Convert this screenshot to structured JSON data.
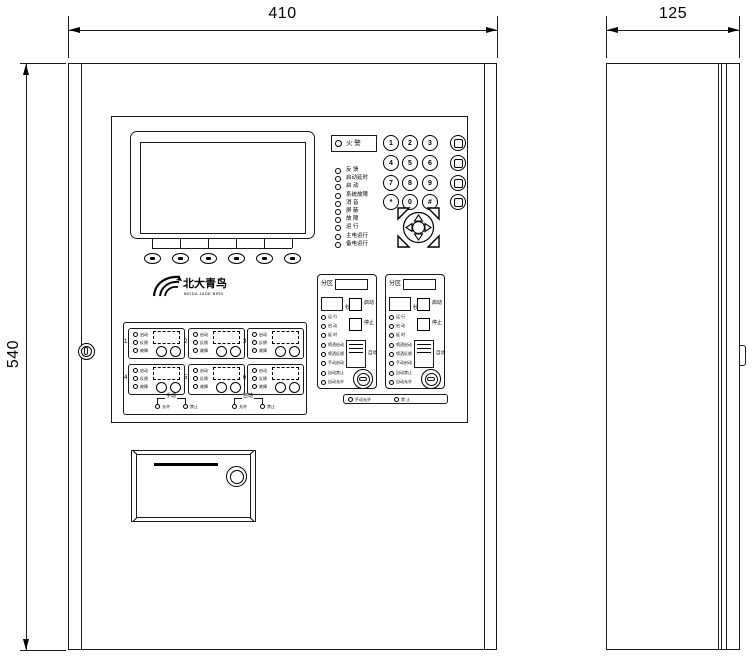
{
  "dimensions": {
    "front_width": "410",
    "side_depth": "125",
    "height": "540"
  },
  "logo": {
    "name": "北大青鸟",
    "subtitle": "BEIDA JADE BIRD"
  },
  "status_panel": {
    "fire_led": "火 警",
    "leds": [
      "反 馈",
      "启动延时",
      "启 动",
      "系统故障",
      "消 音",
      "屏 蔽",
      "故 障",
      "运 行",
      "主电运行",
      "备电运行"
    ]
  },
  "keypad": {
    "digits": [
      "1",
      "2",
      "3",
      "4",
      "5",
      "6",
      "7",
      "8",
      "9",
      "*",
      "0",
      "#"
    ]
  },
  "gas_panel": {
    "zone_label": "分区",
    "second_label": "秒",
    "start_label": "启动",
    "stop_label": "停止",
    "auto_label": "自动",
    "leds": [
      "运 行",
      "启 动",
      "延 时",
      "喷洒启动",
      "喷洒反馈",
      "手动启动",
      "自动禁止",
      "自动允许"
    ],
    "footer_leds": [
      "手动允许",
      "禁 止"
    ]
  },
  "linkage_panel": {
    "module_numbers": [
      "1",
      "2",
      "3",
      "4",
      "5",
      "6"
    ],
    "module_leds": [
      "启动",
      "反馈",
      "故障"
    ],
    "groups": [
      {
        "title": "手动",
        "leds": [
          "允许",
          "禁止"
        ]
      },
      {
        "title": "自动",
        "leds": [
          "允许",
          "禁止"
        ]
      }
    ]
  }
}
